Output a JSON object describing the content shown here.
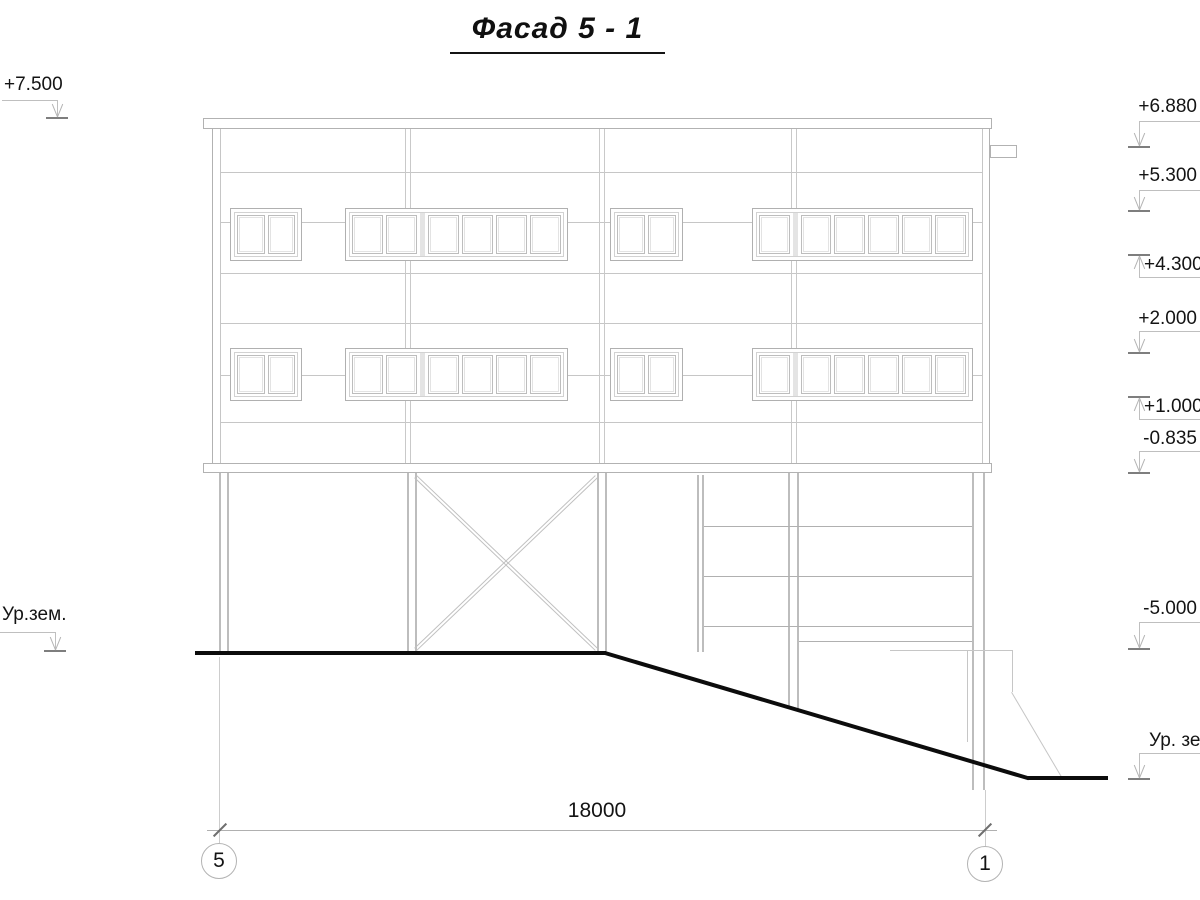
{
  "drawing": {
    "title": "Фасад 5 - 1",
    "dimension_label": "18000",
    "left_marks": [
      {
        "label": "+7.500"
      },
      {
        "label": "Ур.зем."
      }
    ],
    "right_marks": [
      {
        "label": "+6.880",
        "direction": "down"
      },
      {
        "label": "+5.300",
        "direction": "down"
      },
      {
        "label": "+4.300",
        "direction": "up"
      },
      {
        "label": "+2.000",
        "direction": "down"
      },
      {
        "label": "+1.000",
        "direction": "up"
      },
      {
        "label": "-0.835",
        "direction": "down"
      },
      {
        "label": "-5.000",
        "direction": "down"
      },
      {
        "label": "Ур. зем.",
        "direction": "down"
      }
    ],
    "axes": [
      {
        "label": "5"
      },
      {
        "label": "1"
      }
    ],
    "colors": {
      "facade_line": "#c6c6c6",
      "ground_line": "#0c0c0c",
      "text": "#141414"
    }
  }
}
